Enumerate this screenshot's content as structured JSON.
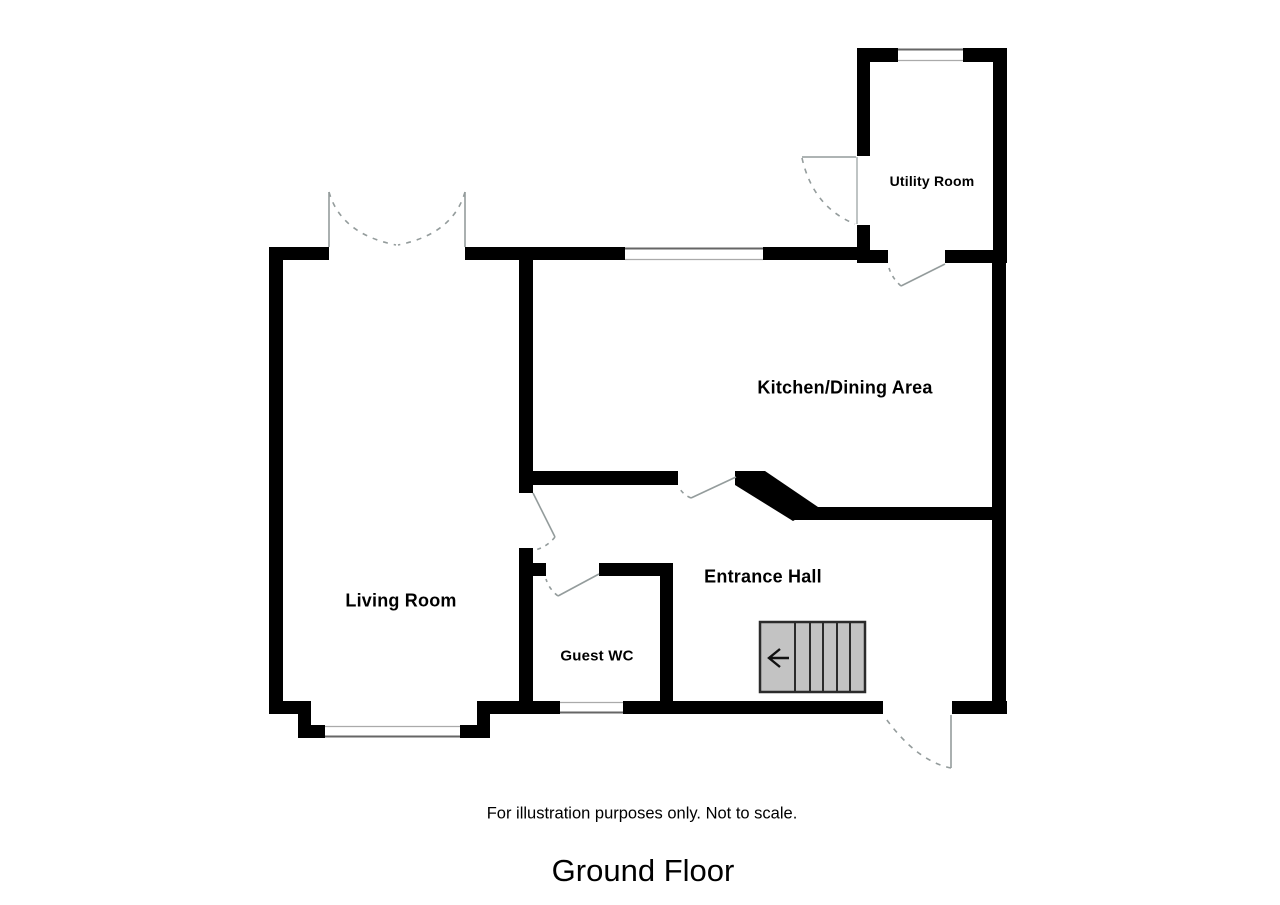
{
  "title": "Ground Floor",
  "footnote": "For illustration purposes only. Not to scale.",
  "rooms": {
    "living_room": {
      "label": "Living Room"
    },
    "kitchen_dining": {
      "label": "Kitchen/Dining Area"
    },
    "utility_room": {
      "label": "Utility Room"
    },
    "entrance_hall": {
      "label": "Entrance Hall"
    },
    "guest_wc": {
      "label": "Guest WC"
    }
  },
  "features": {
    "stairs": {
      "description": "staircase with left-pointing direction arrow",
      "steps_shown": 5
    },
    "doors": [
      "double french doors at top of living room",
      "door living room to entrance hall",
      "door entrance hall to guest wc",
      "door entrance hall to kitchen/dining area",
      "door kitchen/dining area to utility room",
      "external door on utility room west wall",
      "front entrance door on bottom wall"
    ],
    "windows": [
      "kitchen top wall window",
      "utility room top wall window",
      "guest wc bottom wall window",
      "living room bay window at bottom"
    ]
  },
  "colors": {
    "wall": "#000000",
    "background": "#ffffff",
    "door_line": "#949c9c",
    "window_edge": "#666666",
    "stairs_fill": "#c3c3c3",
    "stairs_border": "#2b2b2b",
    "arrow": "#111111",
    "text": "#000000"
  }
}
